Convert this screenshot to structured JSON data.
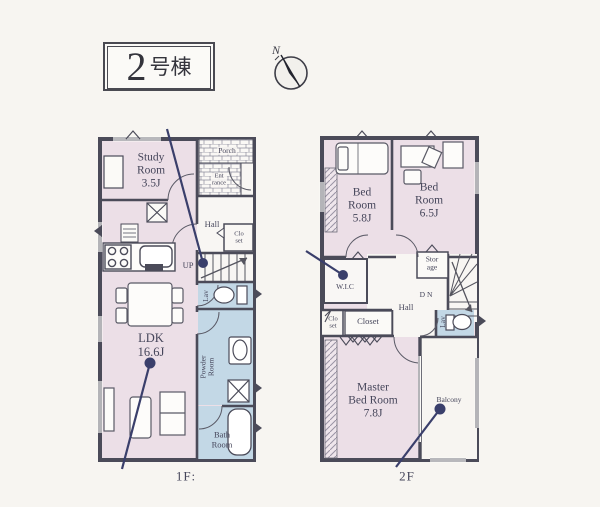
{
  "title": {
    "number": "2",
    "suffix": "号棟"
  },
  "compass": {
    "label": "N"
  },
  "colors": {
    "room_pink": "#ecdfe7",
    "wet_blue": "#c3d8e6",
    "wall": "#4b4b59",
    "annotation_navy": "#3a3f6b",
    "paper": "#f7f5f1"
  },
  "floor1": {
    "label": "1F:",
    "rooms": {
      "study": "Study\nRoom\n3.5J",
      "porch": "Porch",
      "entrance": "Ent\nrance",
      "hall": "Hall",
      "closet": "Clo\nset",
      "up": "UP",
      "lav": "Lav",
      "powder": "Powder\nRoom",
      "bath": "Bath\nRoom",
      "ldk": "LDK\n16.6J"
    }
  },
  "floor2": {
    "label": "2F",
    "rooms": {
      "bedroom1": "Bed\nRoom\n5.8J",
      "bedroom2": "Bed\nRoom\n6.5J",
      "wic": "W.I.C",
      "storage": "Stor\nage",
      "dn": "DN",
      "hall": "Hall",
      "closet_small": "Clo\nset",
      "closet": "Closet",
      "lav": "Lav",
      "master": "Master\nBed Room\n7.8J",
      "balcony": "Balcony"
    }
  }
}
